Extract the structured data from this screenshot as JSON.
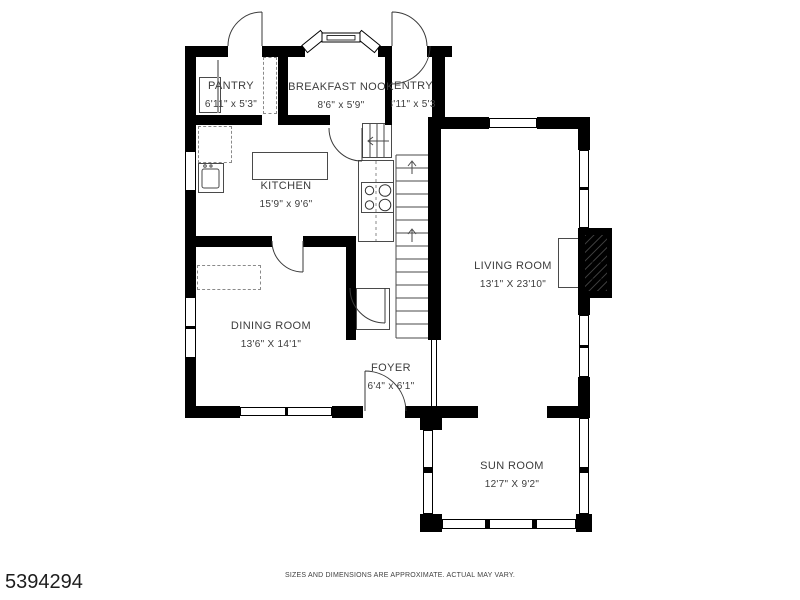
{
  "title": "Residential first-floor plan",
  "rooms": [
    {
      "id": "pantry",
      "name": "PANTRY",
      "dims": "6'11\" x 5'3\""
    },
    {
      "id": "breakfast-nook",
      "name": "BREAKFAST NOOK",
      "dims": "8'6\" x 5'9\""
    },
    {
      "id": "entry",
      "name": "ENTRY",
      "dims": "3'11\" x 5'3\""
    },
    {
      "id": "kitchen",
      "name": "KITCHEN",
      "dims": "15'9\" x 9'6\""
    },
    {
      "id": "living-room",
      "name": "LIVING ROOM",
      "dims": "13'1\" X 23'10\""
    },
    {
      "id": "dining-room",
      "name": "DINING ROOM",
      "dims": "13'6\" X 14'1\""
    },
    {
      "id": "foyer",
      "name": "FOYER",
      "dims": "6'4\" x 6'1\""
    },
    {
      "id": "sun-room",
      "name": "SUN ROOM",
      "dims": "12'7\" X 9'2\""
    }
  ],
  "footer": {
    "disclaimer": "SIZES AND DIMENSIONS ARE APPROXIMATE. ACTUAL MAY VARY.",
    "listing_id": "5394294"
  },
  "colors": {
    "wall": "#000000",
    "linework": "#3a3a3a",
    "background": "#ffffff",
    "label_text": "#3c3c3c"
  }
}
